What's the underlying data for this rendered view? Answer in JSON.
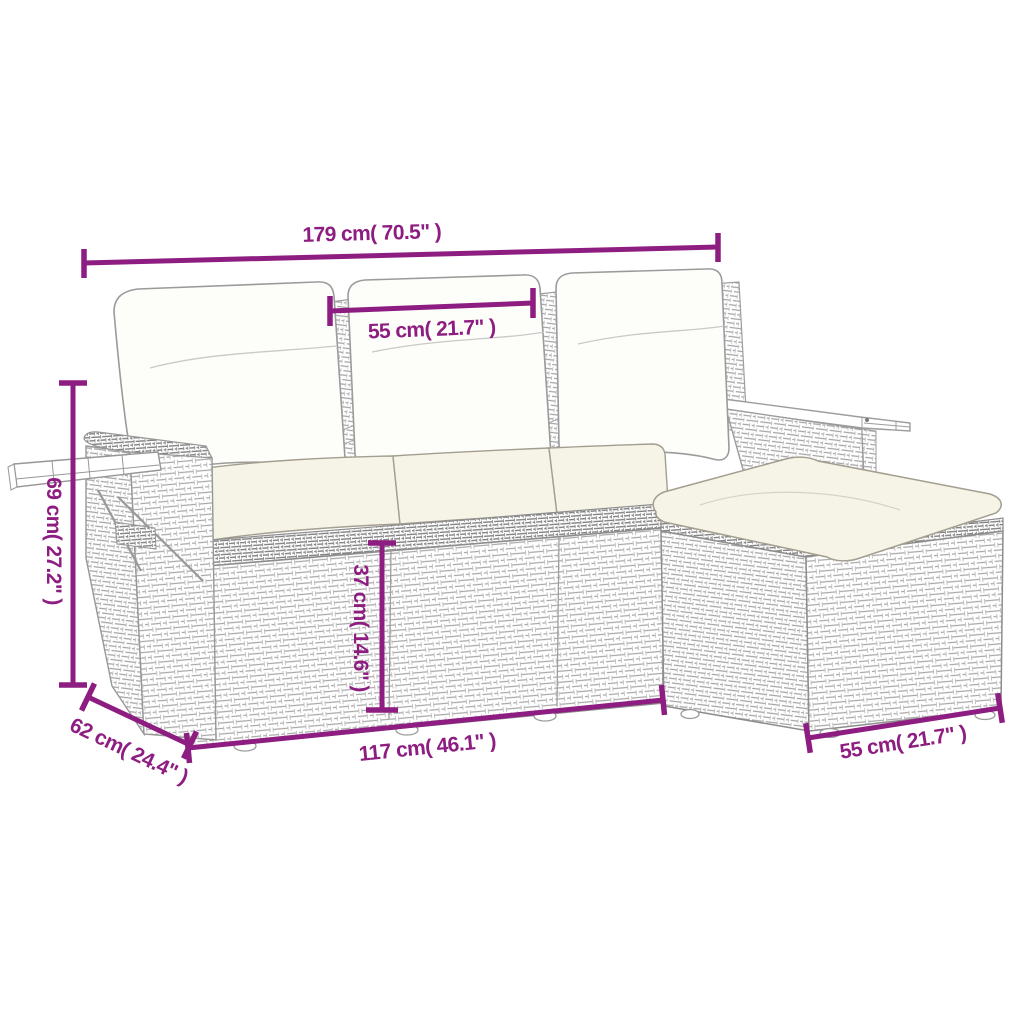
{
  "diagram": {
    "subject": "Poly rattan garden lounge set: 3-seater sofa with back pillows, seat cushions, fold-out side shelves and ottoman",
    "style": "line-art product dimension drawing",
    "background": "#ffffff",
    "accent_color": "#8e1d81",
    "outline_color": "#9a9a9a",
    "cushion_color": "#f6f3e7"
  },
  "dimensions": {
    "total_width": "179 cm( 70.5\" )",
    "backrest_width": "55 cm( 21.7\" )",
    "total_height": "69 cm( 27.2\" )",
    "seat_height": "37 cm( 14.6\" )",
    "depth": "62 cm( 24.4\" )",
    "sofa_length": "117 cm( 46.1\" )",
    "ottoman_width": "55 cm( 21.7\" )"
  }
}
